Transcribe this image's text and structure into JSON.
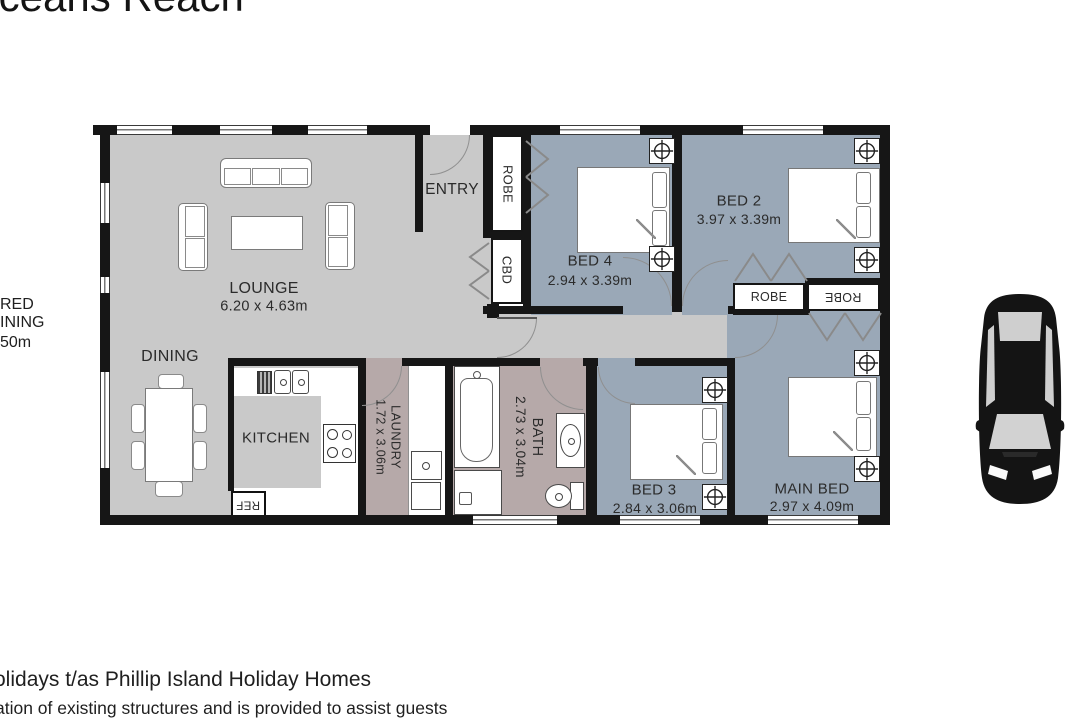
{
  "title": "Oceans Reach",
  "rooms": {
    "lounge": {
      "name": "LOUNGE",
      "dims": "6.20 x 4.63m"
    },
    "dining": {
      "name": "DINING"
    },
    "kitchen": {
      "name": "KITCHEN"
    },
    "entry": {
      "name": "ENTRY"
    },
    "robe_hall": {
      "name": "ROBE"
    },
    "cbd": {
      "name": "CBD"
    },
    "bed2": {
      "name": "BED 2",
      "dims": "3.97 x 3.39m"
    },
    "bed3": {
      "name": "BED 3",
      "dims": "2.84 x 3.06m"
    },
    "bed4": {
      "name": "BED 4",
      "dims": "2.94 x 3.39m"
    },
    "main_bed": {
      "name": "MAIN BED",
      "dims": "2.97 x 4.09m"
    },
    "bath": {
      "name": "BATH",
      "dims": "2.73 x 3.04m"
    },
    "laundry": {
      "name": "LAUNDRY",
      "dims": "1.72 x 3.06m"
    },
    "robe_bed2": {
      "name": "ROBE"
    },
    "robe_main": {
      "name": "ROBE"
    },
    "ref": {
      "name": "REF"
    }
  },
  "edge_fragments": {
    "left_line1": "RED",
    "left_line2": "INING",
    "left_line3": "50m"
  },
  "footer": {
    "line1": "olidays t/as Phillip Island Holiday Homes",
    "line2": "ation of existing structures and is provided to assist guests"
  },
  "colors": {
    "wall": "#161616",
    "living": "#c9c9c9",
    "bedroom": "#9aa8b7",
    "wet": "#b6a9a9"
  }
}
